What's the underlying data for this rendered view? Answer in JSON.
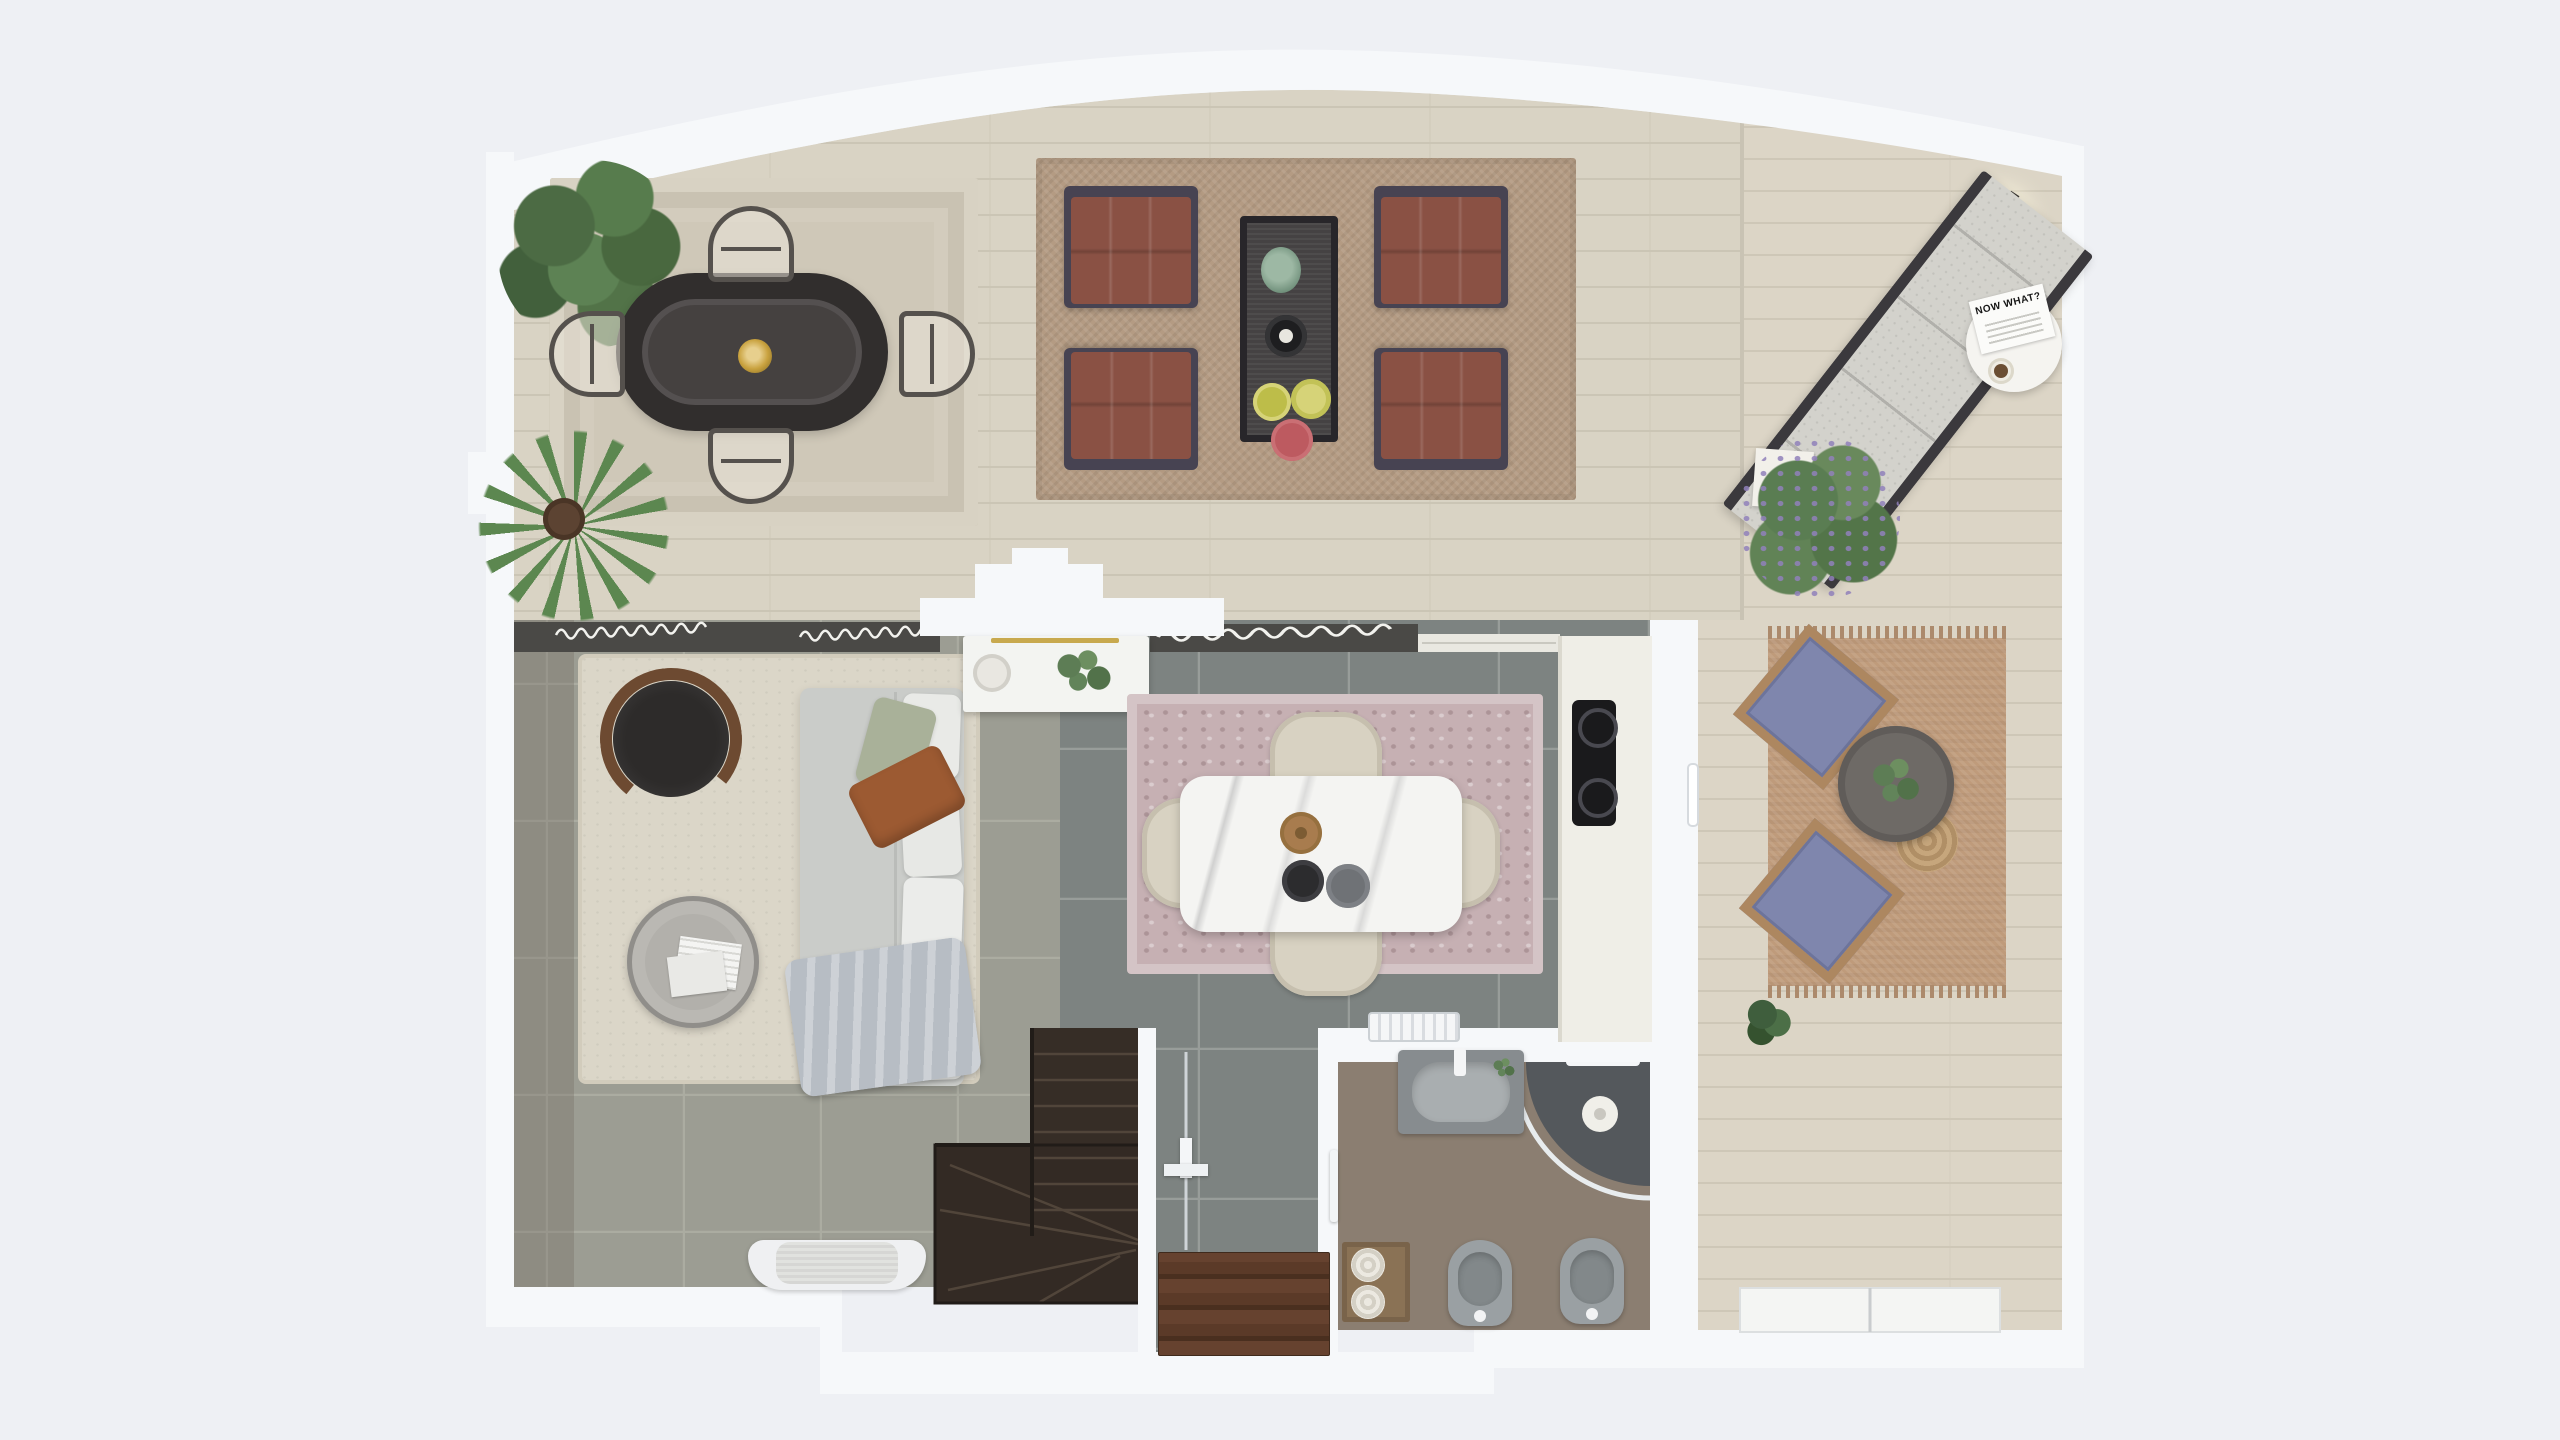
{
  "scene": {
    "kind": "3d-rendered floor plan, top-down view, split-level apartment",
    "background_color": "#eef0f4",
    "texts": {
      "magazine_title": "NOW WHAT?"
    },
    "palette": {
      "wall": "#f6f8fa",
      "floor_upper_travertine": "#d9d3c4",
      "floor_terrace_planks": "#dcd5c6",
      "floor_living_tile": "#9c9d93",
      "floor_kitchen_tile": "#7d8381",
      "floor_bathroom": "#8b7e71",
      "rug_dining": "#cfc8b8",
      "rug_jute": "#b49b83",
      "rug_living": "#dbd6c8",
      "rug_kitchen_pink": "#c6b0b3",
      "rug_patio": "#bf9b7b",
      "armchair_rust": "#8a5144",
      "patio_cushion_blue": "#7f86ad",
      "sofa_gray": "#caccc9",
      "pillow_sage": "#a9b199",
      "pillow_rust": "#9c5a32",
      "stairs_wood": "#362d26",
      "doormat_brown": "#5b3a28",
      "island_marble": "#f4f4f2",
      "cooktop_black": "#1a1a1c",
      "accent_gold": "#c8a94e",
      "plant_green": "#5c8750",
      "lavender_purple": "#9181bb"
    },
    "areas": [
      {
        "name": "dining-area",
        "floor": "travertine",
        "furniture": [
          "oval-rattan-dining-table",
          "pendant-light",
          "dining-chair-x4",
          "leafy-plant",
          "palm-plant",
          "beige-area-rug"
        ]
      },
      {
        "name": "lounge-area",
        "floor": "travertine",
        "furniture": [
          "rust-armchair-x4",
          "slim-coffee-table",
          "vase",
          "tray",
          "plates",
          "jute-rug"
        ]
      },
      {
        "name": "terrace",
        "floor": "wood-planks",
        "furniture": [
          "sun-lounger",
          "round-side-table",
          "magazine",
          "coffee-cup",
          "round-wall-lamp",
          "lavender-planter"
        ]
      },
      {
        "name": "patio-corner",
        "floor": "wood-planks",
        "furniture": [
          "blue-cushion-chair-x2",
          "round-patio-table",
          "jute-pouf",
          "fringed-jute-rug",
          "small-plant"
        ]
      },
      {
        "name": "living-room",
        "floor": "gray-tile",
        "furniture": [
          "gray-sofa",
          "white-pillows",
          "sage-pillow",
          "rust-leather-pillow",
          "throw-blanket",
          "round-lounge-chair",
          "round-coffee-table",
          "magazines",
          "shag-rug",
          "white-armchair",
          "window-curtains"
        ]
      },
      {
        "name": "kitchen",
        "floor": "dark-gray-tile",
        "furniture": [
          "marble-island",
          "island-chair-x4",
          "ornate-pink-rug",
          "induction-cooktop",
          "counter-run",
          "white-sideboard",
          "radiator",
          "window-curtains",
          "step-platform"
        ]
      },
      {
        "name": "bathroom",
        "floor": "taupe",
        "furniture": [
          "vanity-sink",
          "corner-shower",
          "toilet",
          "bidet",
          "towel-shelf",
          "towel-rail"
        ]
      },
      {
        "name": "entry-hall",
        "floor": "dark-gray-tile",
        "furniture": [
          "striped-brown-doormat",
          "coat-hook",
          "glass-door"
        ]
      },
      {
        "name": "staircase",
        "floor": "dark-wood",
        "furniture": [
          "winder-stairs"
        ]
      }
    ]
  },
  "texts": {
    "magazine_title": "NOW WHAT?"
  }
}
